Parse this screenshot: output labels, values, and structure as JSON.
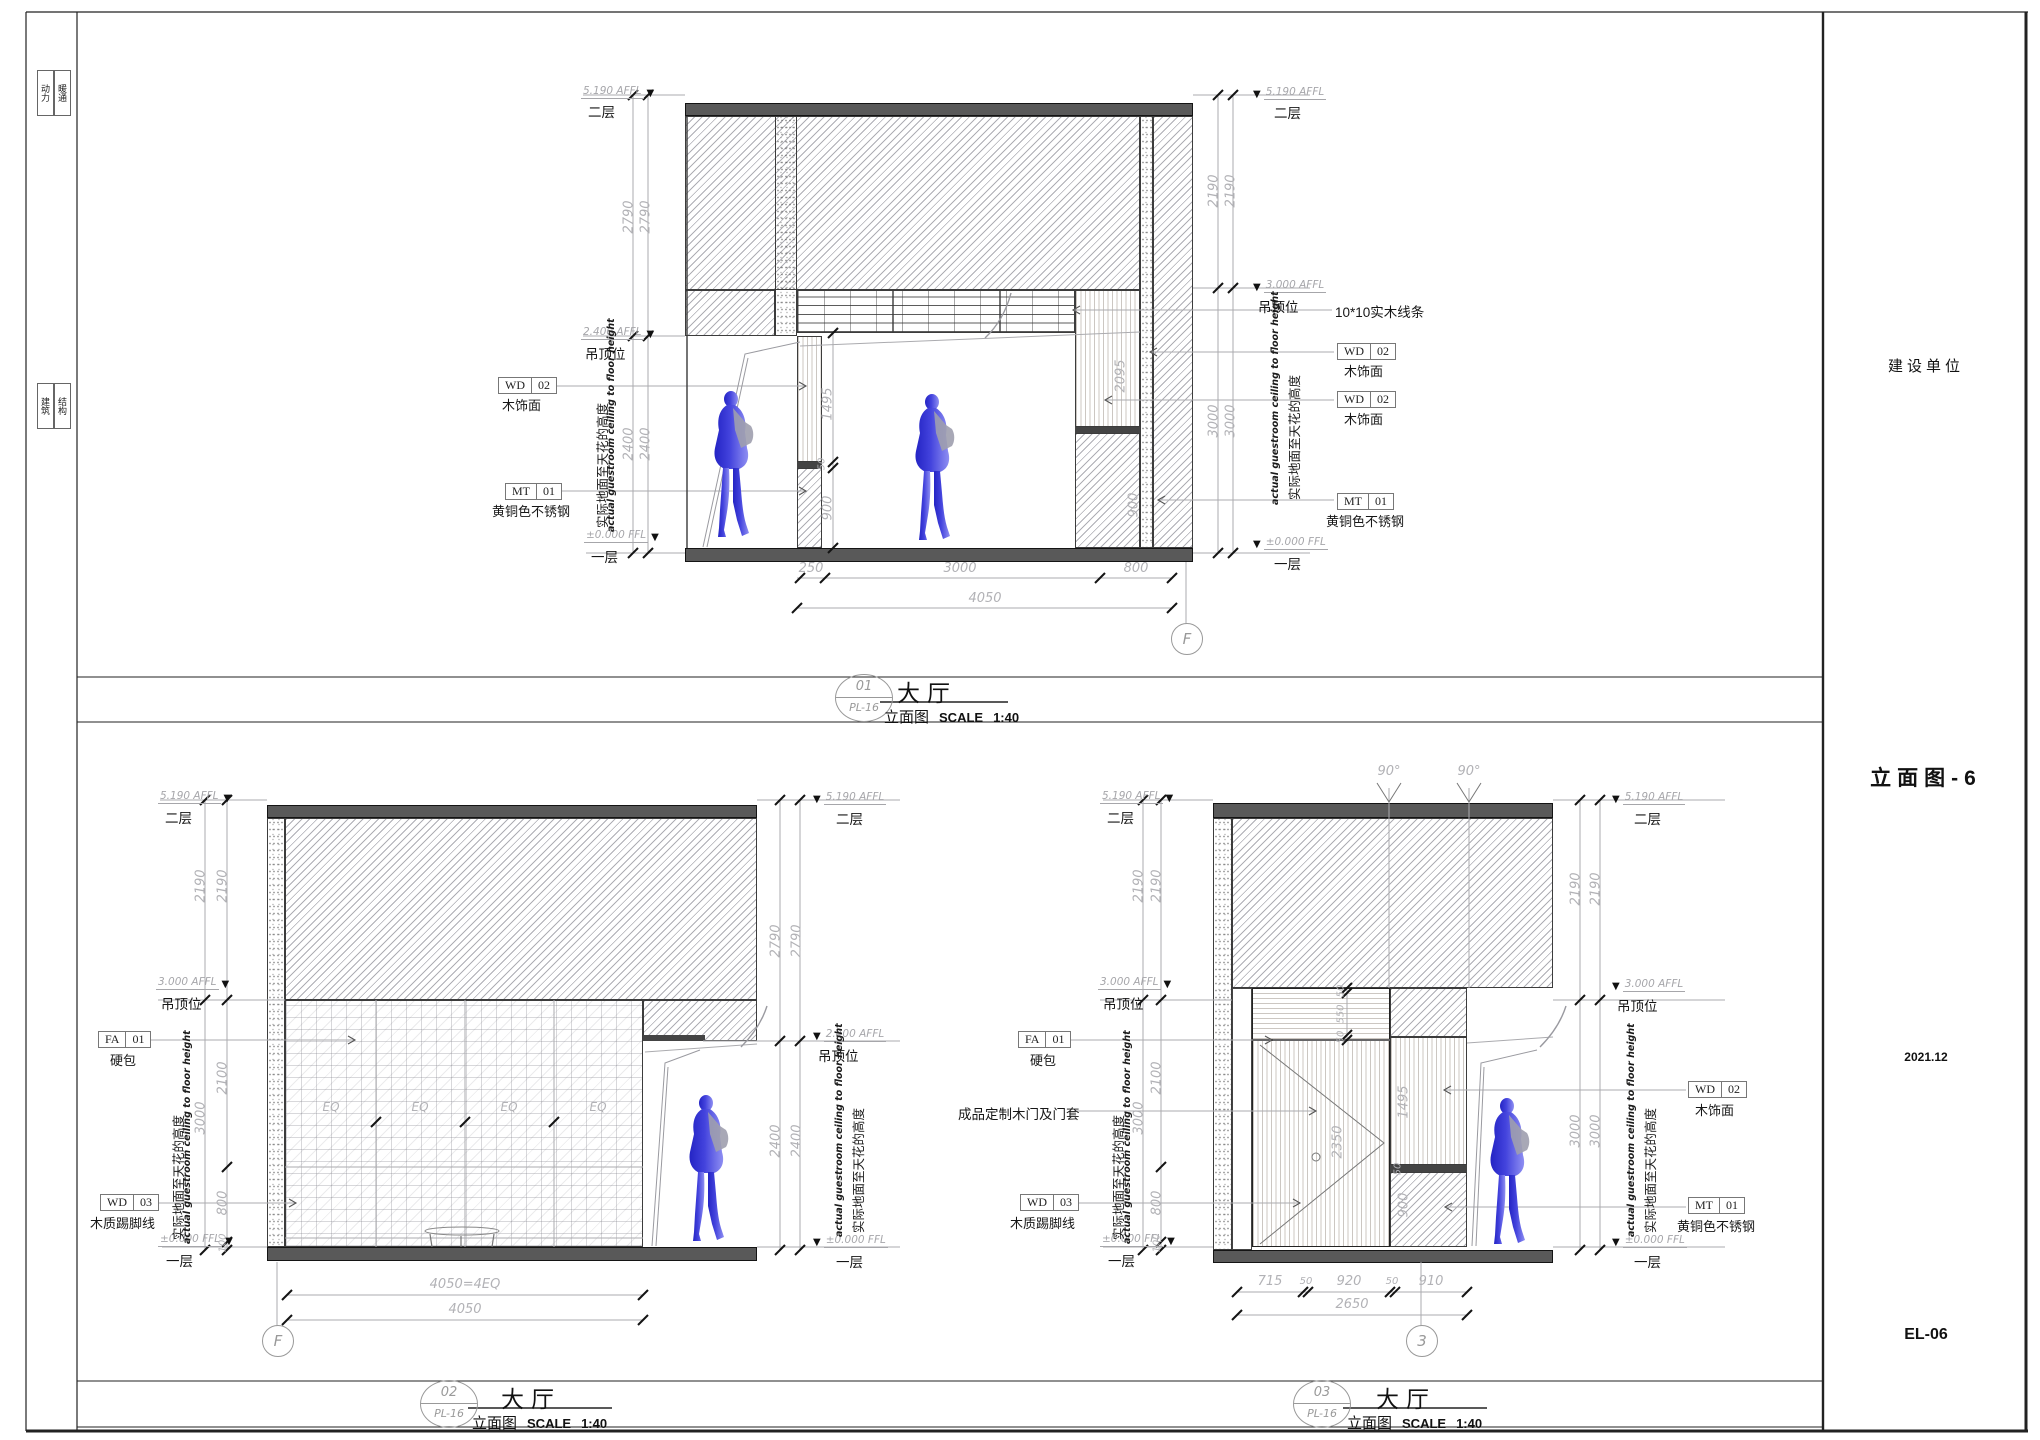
{
  "sheet": {
    "strip": [
      "动力",
      "暖通",
      "建筑",
      "结构"
    ],
    "title_block": {
      "client": "建设单位",
      "sheet_name": "立面图-6",
      "date": "2021.12",
      "sheet_no": "EL-06"
    }
  },
  "common": {
    "room": "大厅",
    "view": "立面图",
    "scale_word": "SCALE",
    "scale": "1:40",
    "ref": "PL-16",
    "tri": "▼",
    "lv5190": "5.190 AFFL",
    "lv3000": "3.000 AFFL",
    "lv2400": "2.400 AFFL",
    "lv0": "±0.000 FFL",
    "f2": "二层",
    "f1": "一层",
    "ceil": "吊顶位",
    "note_cn": "实际地面至天花的高度",
    "note_en": "actual guestroom ceiling to floor height"
  },
  "tags": {
    "wd02": {
      "code": "WD",
      "num": "02",
      "desc": "木饰面"
    },
    "wd03": {
      "code": "WD",
      "num": "03",
      "desc": "木质踢脚线"
    },
    "mt01": {
      "code": "MT",
      "num": "01",
      "desc": "黄铜色不锈钢"
    },
    "fa01": {
      "code": "FA",
      "num": "01",
      "desc": "硬包"
    },
    "trim": "10*10实木线条",
    "door": "成品定制木门及门套"
  },
  "d01": {
    "no": "01",
    "grid": "F",
    "dl_top": [
      "2790",
      "2790"
    ],
    "dl_bot": [
      "2400",
      "2400"
    ],
    "dr_top": [
      "2190",
      "2190"
    ],
    "dr_bot": [
      "3000",
      "3000"
    ],
    "i1495": "1495",
    "i50": "50",
    "i900l": "900",
    "i2095": "2095",
    "i900r": "900",
    "b1": "250",
    "b2": "3000",
    "b3": "800",
    "btot": "4050"
  },
  "d02": {
    "no": "02",
    "grid": "F",
    "dl_top": [
      "2190",
      "2190"
    ],
    "dl3000": "3000",
    "dl2100": "2100",
    "dl800": "800",
    "dl100": "100",
    "dr_top": [
      "2790",
      "2790"
    ],
    "dr_bot": [
      "2400",
      "2400"
    ],
    "eq": [
      "EQ",
      "EQ",
      "EQ",
      "EQ"
    ],
    "btot1": "4050=4EQ",
    "btot2": "4050"
  },
  "d03": {
    "no": "03",
    "grid": "3",
    "angle": "90°",
    "dl_top": [
      "2190",
      "2190"
    ],
    "dl3000": "3000",
    "dl2100": "2100",
    "dl800": "800",
    "dl100": "100",
    "dr_top": [
      "2190",
      "2190"
    ],
    "dr_bot": [
      "3000",
      "3000"
    ],
    "t50a": "50",
    "t550": "550",
    "t50b": "50",
    "i2350": "2350",
    "i1495": "1495",
    "i50": "50",
    "i900": "900",
    "b1": "715",
    "b2": "50",
    "b3": "920",
    "b4": "50",
    "b5": "910",
    "btot": "2650"
  }
}
